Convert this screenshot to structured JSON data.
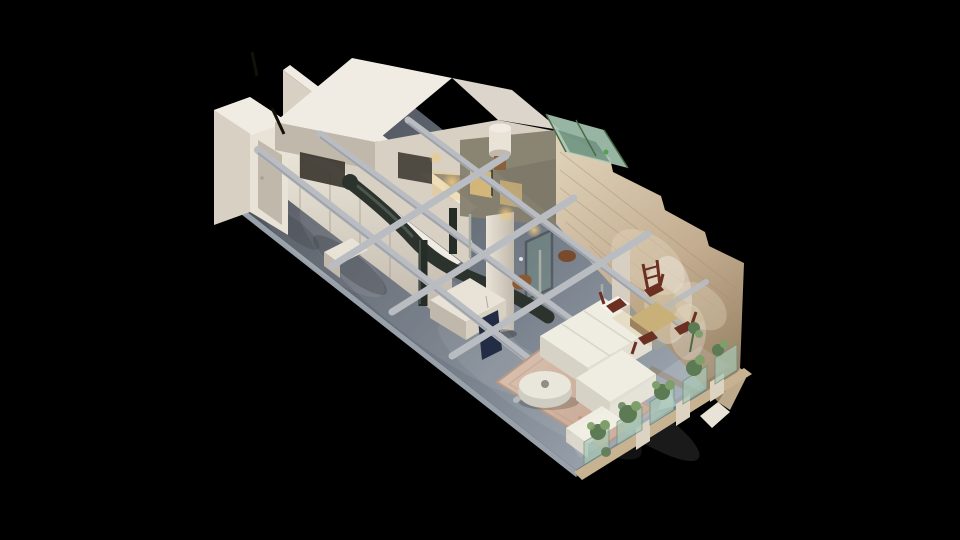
{
  "scene": {
    "description": "Dollhouse-style 3D scan of a loft apartment viewed from above at an oblique angle, floating on a black background. Left end holds white paneled kitchen cabinetry and a bathroom volume; center shows exposed gray ceiling beams, a dark curved HVAC duct and a white support column; right end is a living/dining area with a white sectional sofa, round ottoman on a patterned rug, wood dining table with dark red chairs, a tall exposed-brick wall and a window wall lined with plants.",
    "view": "dollhouse",
    "objects": [
      "concrete-floor",
      "kitchen-cabinets",
      "bathroom-volume",
      "white-partition-walls",
      "upper-room-volumes",
      "exposed-brick-wall",
      "glass-skylight",
      "window-wall",
      "ceiling-beams",
      "hvac-duct",
      "support-column",
      "water-heater",
      "shower-glass",
      "sectional-sofa",
      "round-ottoman",
      "area-rug",
      "dining-table",
      "dining-chairs",
      "ladder-back-chair",
      "leather-armchairs",
      "wall-art",
      "recessed-lights",
      "plants"
    ]
  },
  "palette": {
    "background": "#000000",
    "floorDark": "#4b4f58",
    "floorMid": "#747d88",
    "floorLight": "#a2abb4",
    "floorEdge": "#98a0a9",
    "floorPatch": "#262b31",
    "wallLit": "#e9e3d7",
    "wallMid": "#d7d0c3",
    "wallShade": "#c0b8ab",
    "wallDark": "#a59d90",
    "roofTop": "#f0ebe3",
    "roof2": "#dbd5cb",
    "interiorDark": "#37332b",
    "interiorWall": "#867f6f",
    "brick": "#c3ac8f",
    "brickLight": "#ddd0b7",
    "brickDark": "#8f7a5e",
    "brickLine": "#a78e6f",
    "glassGreen": "#a8c8b5",
    "glassDark": "#6d8e7d",
    "glassLight": "#bcd8ca",
    "skylightDot": "#57a04e",
    "plant": "#5c7a54",
    "plantLight": "#7e9f6a",
    "plantStem": "#4c6a46",
    "duct": "#2c332d",
    "ductHi": "#57675d",
    "pipe": "#262c26",
    "beam": "#b9bdc2",
    "beamDark": "#8e939a",
    "rod": "#a9ada2",
    "sofa": "#efece1",
    "sofaShade": "#d6d2c5",
    "sofaSide": "#e2ded2",
    "cushionLine": "#d9d5c7",
    "pillow": "#f6f3ea",
    "rug": "#d9c1af",
    "rugDark": "#c2a08c",
    "rugBorder": "#b99a85",
    "rugDot": "#b4826e",
    "ottoman": "#e9e6db",
    "ottomanSide": "#cfccc2",
    "ottomanDot": "#6a675f",
    "wood": "#c9b078",
    "woodDark": "#8a6b44",
    "chair": "#6c3023",
    "leather": "#8a5a34",
    "leather2": "#7a4a2c",
    "navy": "#232c45",
    "warmLight": "#eec87e",
    "tanBase": "#c7b292",
    "sill": "#ddd3c2",
    "white": "#ffffff",
    "black": "#000000",
    "pole": "#141109",
    "heaterStand": "#8a5f3c",
    "frameDark": "#1d1d1d"
  }
}
